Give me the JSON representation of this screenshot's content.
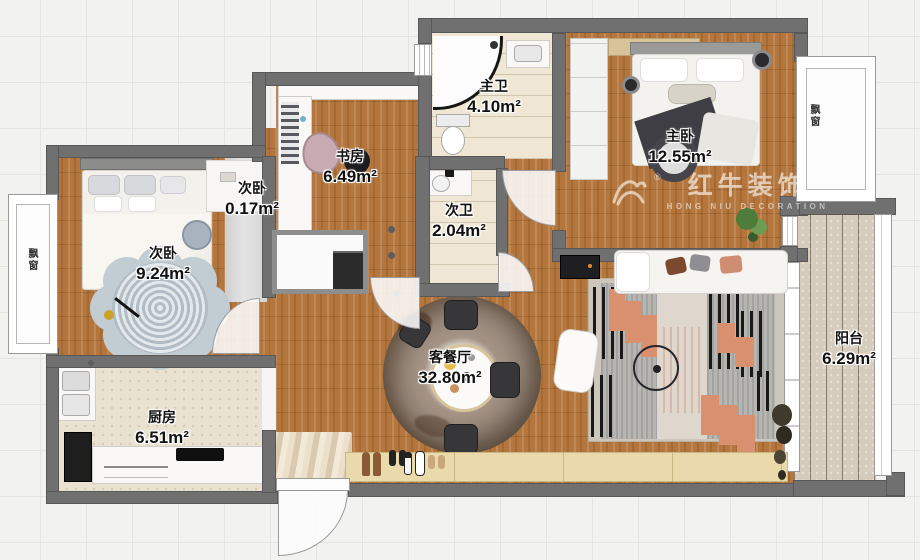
{
  "watermark": {
    "brand": "红牛装饰",
    "registered": "®",
    "subtitle": "HONG NIU DECORATION"
  },
  "rooms": [
    {
      "key": "master-bath",
      "name": "主卫",
      "area": "4.10m²"
    },
    {
      "key": "second-bath",
      "name": "次卫",
      "area": "2.04m²"
    },
    {
      "key": "study",
      "name": "书房",
      "area": "6.49m²"
    },
    {
      "key": "closet",
      "name": "次卧",
      "area": "0.17m²"
    },
    {
      "key": "second-bedroom",
      "name": "次卧",
      "area": "9.24m²"
    },
    {
      "key": "kitchen",
      "name": "厨房",
      "area": "6.51m²"
    },
    {
      "key": "living-dining",
      "name": "客餐厅",
      "area": "32.80m²"
    },
    {
      "key": "master-bedroom",
      "name": "主卧",
      "area": "12.55m²"
    },
    {
      "key": "balcony",
      "name": "阳台",
      "area": "6.29m²"
    }
  ],
  "annotations": {
    "bay_window_left": "飘窗",
    "bay_window_right": "飘窗"
  },
  "colors": {
    "wall": "#707070",
    "wood": "#b4763c",
    "accent_salmon": "#d9906f",
    "bath_floor": "#efe7d4",
    "balcony_floor": "#d6ccbd",
    "rug_blue_gray": "#c2ccd3"
  }
}
